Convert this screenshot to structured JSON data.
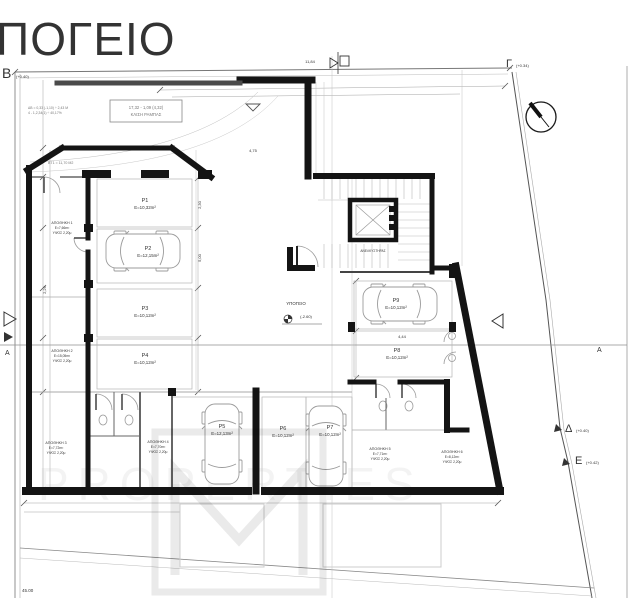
{
  "title": "ΠΟΓΕΙΟ",
  "colors": {
    "wall": "#141414",
    "thin_line": "#9a9a9a",
    "bay_line": "#b5b5b5",
    "text": "#222222"
  },
  "markers": {
    "b": {
      "letter": "Β",
      "level": "(+0.40)"
    },
    "gamma": {
      "letter": "Γ",
      "level": "(+0.34)"
    },
    "delta": {
      "letter": "Δ",
      "level": "(+0.40)"
    },
    "epsilon": {
      "letter": "Ε",
      "level": "(+0.42)"
    },
    "section_left": "Α",
    "section_right": "Α"
  },
  "floor_note": {
    "label": "ΥΠΟΓΕΙΟ",
    "level": "(-2.60)"
  },
  "elevator": {
    "label": "ΑΝΕΛΚΥΣΤΗΡΑΣ"
  },
  "ramp_note": {
    "line1": "17,32 - 1,09 (4,32)",
    "line2": "ΚΛΙΣΗ ΡΑΜΠΑΣ"
  },
  "side_notes": {
    "line1": "ΔΒ = 0,33 (-1,10) ÷ 2,43 Μ",
    "line2": "4 - 1,2,34(1) ÷ 40,17%",
    "line3": "ΒΤ1 = 11,70 Μ2"
  },
  "parking": [
    {
      "id": "P1",
      "area": "Ε=10,32m²"
    },
    {
      "id": "P2",
      "area": "Ε=12,15m²"
    },
    {
      "id": "P3",
      "area": "Ε=10,12m²"
    },
    {
      "id": "P4",
      "area": "Ε=10,12m²"
    },
    {
      "id": "P5",
      "area": "Ε=12,13m²"
    },
    {
      "id": "P6",
      "area": "Ε=10,12m²"
    },
    {
      "id": "P7",
      "area": "Ε=10,12m²"
    },
    {
      "id": "P8",
      "area": "Ε=10,12m²"
    },
    {
      "id": "P9",
      "area": "Ε=10,12m²"
    }
  ],
  "storage": [
    {
      "name": "ΑΠΟΘΗΚΗ 1",
      "area": "Ε=7,66m²",
      "height": "ΥΨΟΣ 2,20μ"
    },
    {
      "name": "ΑΠΟΘΗΚΗ 2",
      "area": "Ε=15,05m²",
      "height": "ΥΨΟΣ 2,20μ"
    },
    {
      "name": "ΑΠΟΘΗΚΗ 3",
      "area": "Ε=7,72m²",
      "height": "ΥΨΟΣ 2,20μ"
    },
    {
      "name": "ΑΠΟΘΗΚΗ 4",
      "area": "Ε=7,70m²",
      "height": "ΥΨΟΣ 2,20μ"
    },
    {
      "name": "ΑΠΟΘΗΚΗ 5",
      "area": "Ε=7,71m²",
      "height": "ΥΨΟΣ 2,20μ"
    },
    {
      "name": "ΑΠΟΘΗΚΗ 6",
      "area": "Ε=8,12m²",
      "height": "ΥΨΟΣ 2,20μ"
    }
  ],
  "dims": {
    "top": "11,84",
    "ramp": "4,75",
    "bay_w": "2,30",
    "bay_d": "5,00",
    "p8_w": "4,44",
    "left_h": "2,29",
    "plot_bottom": "45.00"
  },
  "watermark": {
    "logo_letter": "M",
    "band_text": "PROPERTIES"
  }
}
